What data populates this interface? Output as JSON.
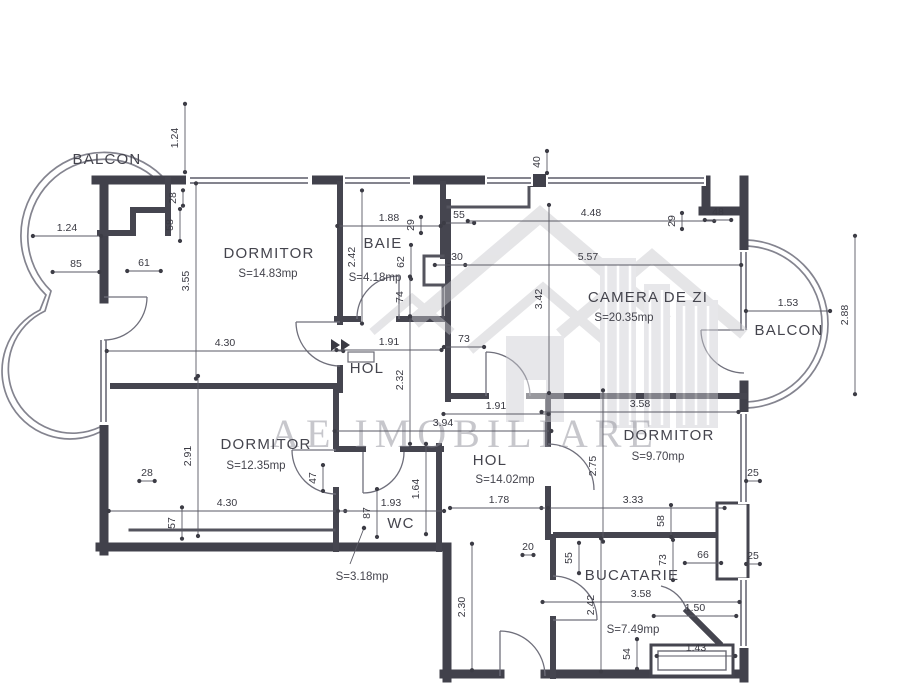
{
  "document": {
    "type": "apartment-floor-plan"
  },
  "watermark": {
    "brand": "AE IMOBILIARE"
  },
  "rooms": [
    {
      "name": "BALCON",
      "area": ""
    },
    {
      "name": "DORMITOR",
      "area": "S=14.83mp"
    },
    {
      "name": "BAIE",
      "area": "S=4.18mp"
    },
    {
      "name": "CAMERA DE ZI",
      "area": "S=20.35mp"
    },
    {
      "name": "BALCON",
      "area": ""
    },
    {
      "name": "HOL",
      "area": ""
    },
    {
      "name": "DORMITOR",
      "area": "S=12.35mp"
    },
    {
      "name": "DORMITOR",
      "area": "S=9.70mp"
    },
    {
      "name": "HOL",
      "area": "S=14.02mp"
    },
    {
      "name": "WC",
      "area": "S=3.18mp"
    },
    {
      "name": "BUCATARIE",
      "area": "S=7.49mp"
    }
  ],
  "dimensions": [
    {
      "v": "1.24",
      "x": 67,
      "y": 231,
      "r": 0
    },
    {
      "v": "85",
      "x": 76,
      "y": 267,
      "r": 0
    },
    {
      "v": "61",
      "x": 144,
      "y": 266,
      "r": 0
    },
    {
      "v": "1.88",
      "x": 389,
      "y": 221,
      "r": 0
    },
    {
      "v": "55",
      "x": 459,
      "y": 218,
      "r": 0
    },
    {
      "v": "4.48",
      "x": 591,
      "y": 216,
      "r": 0
    },
    {
      "v": "48",
      "x": 718,
      "y": 215,
      "r": 0
    },
    {
      "v": "30",
      "x": 457,
      "y": 260,
      "r": 0
    },
    {
      "v": "5.57",
      "x": 588,
      "y": 260,
      "r": 0
    },
    {
      "v": "4.30",
      "x": 225,
      "y": 346,
      "r": 0
    },
    {
      "v": "1.91",
      "x": 389,
      "y": 345,
      "r": 0
    },
    {
      "v": "73",
      "x": 464,
      "y": 342,
      "r": 0
    },
    {
      "v": "1.53",
      "x": 788,
      "y": 306,
      "r": 0
    },
    {
      "v": "1.91",
      "x": 496,
      "y": 409,
      "r": 0
    },
    {
      "v": "3.58",
      "x": 640,
      "y": 407,
      "r": 0
    },
    {
      "v": "3.94",
      "x": 443,
      "y": 426,
      "r": 0
    },
    {
      "v": "28",
      "x": 147,
      "y": 476,
      "r": 0
    },
    {
      "v": "4.30",
      "x": 227,
      "y": 506,
      "r": 0
    },
    {
      "v": "1.93",
      "x": 391,
      "y": 506,
      "r": 0
    },
    {
      "v": "3.33",
      "x": 633,
      "y": 503,
      "r": 0
    },
    {
      "v": "1.78",
      "x": 499,
      "y": 503,
      "r": 0
    },
    {
      "v": "66",
      "x": 703,
      "y": 558,
      "r": 0
    },
    {
      "v": "25",
      "x": 753,
      "y": 476,
      "r": 0
    },
    {
      "v": "25",
      "x": 753,
      "y": 559,
      "r": 0
    },
    {
      "v": "20",
      "x": 528,
      "y": 550,
      "r": 0
    },
    {
      "v": "3.58",
      "x": 641,
      "y": 597,
      "r": 0
    },
    {
      "v": "1.50",
      "x": 695,
      "y": 611,
      "r": 0
    },
    {
      "v": "1.43",
      "x": 696,
      "y": 651,
      "r": 0
    },
    {
      "v": "1.24",
      "x": 178,
      "y": 138,
      "r": 1
    },
    {
      "v": "28",
      "x": 176,
      "y": 198,
      "r": 1
    },
    {
      "v": "58",
      "x": 173,
      "y": 225,
      "r": 1
    },
    {
      "v": "3.55",
      "x": 189,
      "y": 281,
      "r": 1
    },
    {
      "v": "2.42",
      "x": 355,
      "y": 257,
      "r": 1
    },
    {
      "v": "29",
      "x": 414,
      "y": 225,
      "r": 1
    },
    {
      "v": "62",
      "x": 404,
      "y": 262,
      "r": 1
    },
    {
      "v": "74",
      "x": 403,
      "y": 297,
      "r": 1
    },
    {
      "v": "29",
      "x": 675,
      "y": 221,
      "r": 1
    },
    {
      "v": "40",
      "x": 540,
      "y": 162,
      "r": 1
    },
    {
      "v": "3.42",
      "x": 542,
      "y": 299,
      "r": 1
    },
    {
      "v": "2.88",
      "x": 848,
      "y": 315,
      "r": 1
    },
    {
      "v": "2.32",
      "x": 403,
      "y": 380,
      "r": 1
    },
    {
      "v": "2.91",
      "x": 191,
      "y": 456,
      "r": 1
    },
    {
      "v": "47",
      "x": 316,
      "y": 478,
      "r": 1
    },
    {
      "v": "57",
      "x": 175,
      "y": 523,
      "r": 1
    },
    {
      "v": "87",
      "x": 370,
      "y": 513,
      "r": 1
    },
    {
      "v": "1.64",
      "x": 419,
      "y": 489,
      "r": 1
    },
    {
      "v": "2.75",
      "x": 596,
      "y": 466,
      "r": 1
    },
    {
      "v": "58",
      "x": 664,
      "y": 521,
      "r": 1
    },
    {
      "v": "55",
      "x": 572,
      "y": 558,
      "r": 1
    },
    {
      "v": "73",
      "x": 666,
      "y": 560,
      "r": 1
    },
    {
      "v": "2.42",
      "x": 594,
      "y": 605,
      "r": 1
    },
    {
      "v": "54",
      "x": 630,
      "y": 654,
      "r": 1
    },
    {
      "v": "2.30",
      "x": 465,
      "y": 607,
      "r": 1
    }
  ]
}
